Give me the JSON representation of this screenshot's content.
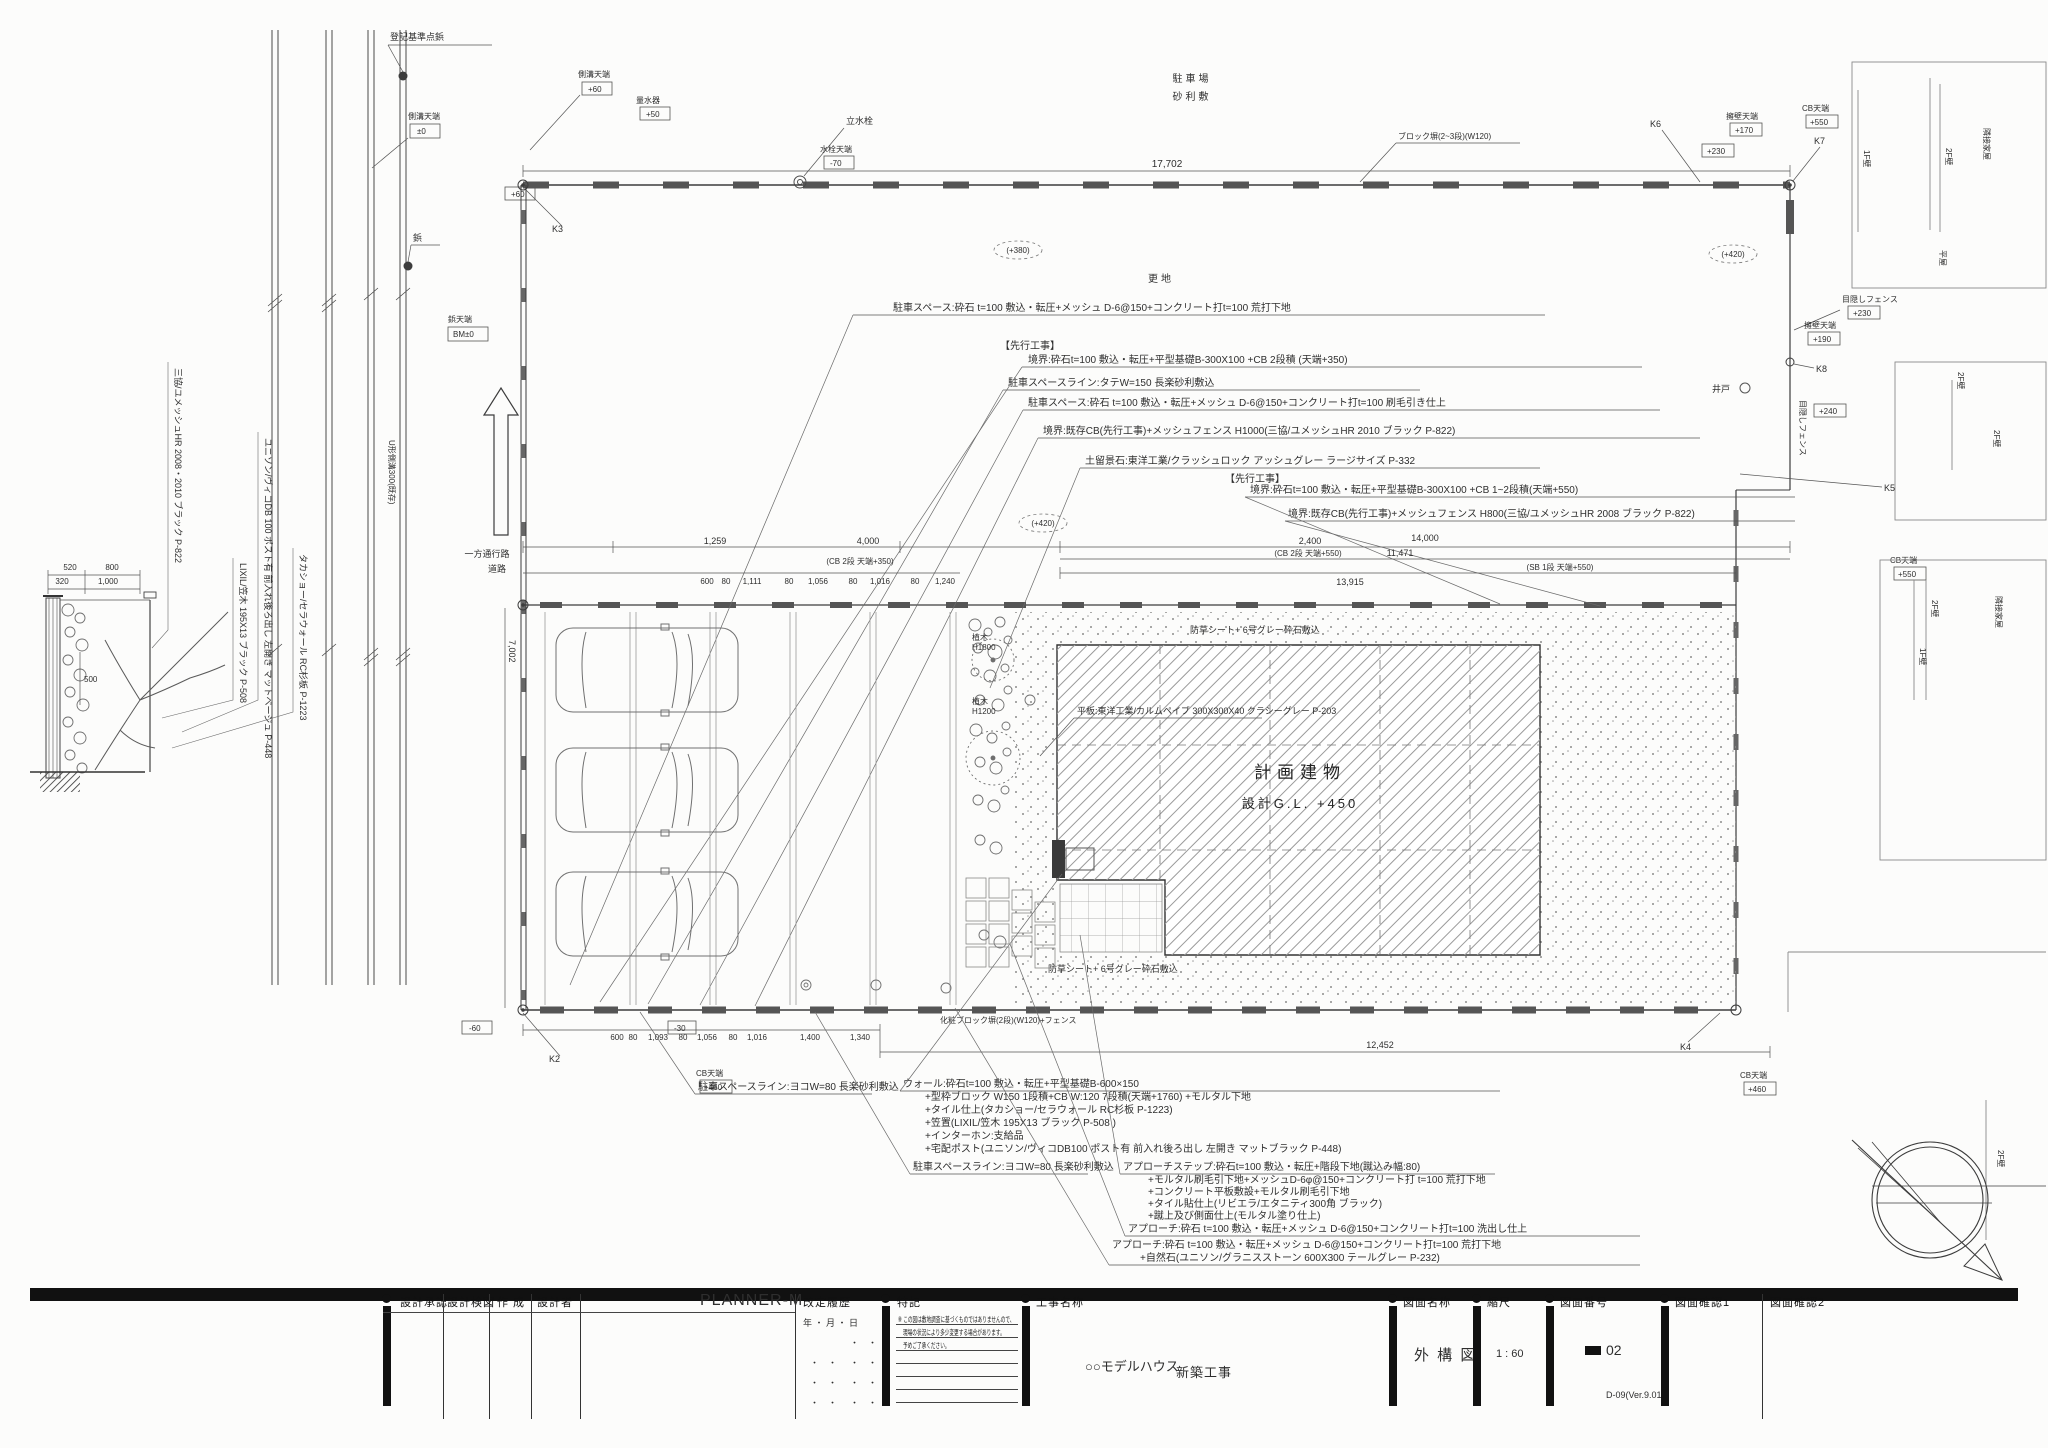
{
  "title_block": {
    "approval": "設計承認",
    "check": "設計検図",
    "create": "作 成",
    "designer_label": "設計者",
    "designer": "PLANNER-M",
    "revision": "改定履歴",
    "revision_date": "年 ・ 月 ・ 日",
    "dot": "・　・",
    "notes_label": "特記",
    "note1": "※ この図は敷地調査に基づくものではありませんので、",
    "note2": "現場の状況により多少変更する場合があります。",
    "note3": "予めご了承ください。",
    "project_label": "工事名称",
    "project_name": "○○モデルハウス",
    "project_type": "新築工事",
    "drawing_label": "図面名称",
    "drawing_name": "外 構 図",
    "scale_label": "縮尺",
    "scale": "1 : 60",
    "number_label": "図面番号",
    "number": "02",
    "version": "D-09(Ver.9.01)",
    "confirm1": "図面確認1",
    "confirm2": "図面確認2"
  },
  "notes_top": [
    "駐車スペース:砕石 t=100 敷込・転圧+メッシュ D-6@150+コンクリート打t=100 荒打下地",
    "【先行工事】",
    "境界:砕石t=100 敷込・転圧+平型基礎B-300X100 +CB 2段積 (天端+350)",
    "駐車スペースライン:タテW=150 長楽砂利敷込",
    "駐車スペース:砕石 t=100 敷込・転圧+メッシュ D-6@150+コンクリート打t=100 刷毛引き仕上",
    "境界:既存CB(先行工事)+メッシュフェンス H1000(三協/ユメッシュHR 2010 ブラック P-822)",
    "土留景石:東洋工業/クラッシュロック アッシュグレー ラージサイズ P-332",
    "【先行工事】",
    "境界:砕石t=100 敷込・転圧+平型基礎B-300X100 +CB 1~2段積(天端+550)",
    "境界:既存CB(先行工事)+メッシュフェンス H800(三協/ユメッシュHR 2008 ブラック P-822)"
  ],
  "notes_wall": [
    "ウォール:砕石t=100 敷込・転圧+平型基礎B-600×150",
    "+型枠ブロック W150 1段積+CB W:120 7段積(天端+1760) +モルタル下地",
    "+タイル仕上(タカショー/セラウォール RC杉板 P-1223)",
    "+笠置(LIXIL/笠木 195X13 ブラック P-508 )",
    "+インターホン:支給品",
    "+宅配ポスト(ユニソン/ヴィコDB100 ポスト有 前入れ後ろ出し 左開き マットブラック P-448)"
  ],
  "notes_step": [
    "アプローチステップ:砕石t=100 敷込・転圧+階段下地(蹴込み幅:80)",
    "+モルタル刷毛引下地+メッシュD-6φ@150+コンクリート打 t=100 荒打下地",
    "+コンクリート平板敷設+モルタル刷毛引下地",
    "+タイル貼仕上(リビエラ/エタニティ300角 ブラック)",
    "+蹴上及び側面仕上(モルタル塗り仕上)"
  ],
  "notes_approach": [
    "アプローチ:砕石 t=100 敷込・転圧+メッシュ D-6@150+コンクリート打t=100 洗出し仕上",
    "アプローチ:砕石 t=100 敷込・転圧+メッシュ D-6@150+コンクリート打t=100 荒打下地",
    "+自然石(ユニソン/グラニスストーン 600X300 テールグレー P-232)"
  ],
  "notes_misc": {
    "parkline_yoko": "駐車スペースライン:ヨコW=80 長楽砂利敷込",
    "plate": "平板:東洋工業/カルムペイブ 300X300X40 クラシーグレー P-203",
    "bousou": "防草シート+ 6号グレー砕石敷込",
    "block_top": "ブロック塀(2~3段)(W120)",
    "block_bottom": "化粧ブロック塀(2段)(W120)+フェンス"
  },
  "building": {
    "name": "計画建物",
    "gl": "設計G.L. +450"
  },
  "site": {
    "sarachi": "更地",
    "parking": "駐車場",
    "gravel": "砂利敷",
    "tap": "立水栓",
    "tap_top": "水栓天端",
    "meter": "量水器",
    "well": "井戸",
    "oneway": "一方通行路",
    "road": "道路",
    "gutter": "U形側溝300(既存)",
    "tree": "植木",
    "tree1h": "H1800",
    "tree2h": "H1200",
    "fence_hide": "目隠しフェンス",
    "youheki": "擁壁天端",
    "cbtop": "CB天端",
    "sokko": "側溝天端",
    "byo": "鋲",
    "byotop": "鋲天端",
    "kijun": "登記基準点鋲",
    "f1": "1F壁",
    "f2": "2F壁",
    "house": "隣接家屋",
    "hiraya": "平屋"
  },
  "levels": {
    "pm0": "±0",
    "bm": "BM±0",
    "p50": "+50",
    "p60": "+60",
    "p170": "+170",
    "p190": "+190",
    "p230": "+230",
    "p240": "+240",
    "p380": "(+380)",
    "p420": "(+420)",
    "p460": "+460",
    "p550": "+550",
    "m30": "-30",
    "m60": "-60",
    "m70": "-70"
  },
  "markers": {
    "k2": "K2",
    "k3": "K3",
    "k4": "K4",
    "k5": "K5",
    "k6": "K6",
    "k7": "K7",
    "k8": "K8"
  },
  "dims": {
    "top": "17,702",
    "rowA": [
      "1,259",
      "4,000",
      "2,400",
      "14,000",
      "11,471",
      "13,915"
    ],
    "rowA_notes": [
      "(CB 2段 天端+350)",
      "(CB 2段 天端+550)",
      "(SB 1段 天端+550)"
    ],
    "rowB": [
      "600",
      "80",
      "1,111",
      "80",
      "1,056",
      "80",
      "1,016",
      "80",
      "1,240"
    ],
    "bottom": [
      "600",
      "80",
      "1,093",
      "80",
      "1,056",
      "80",
      "1,016",
      "1,400",
      "1,340"
    ],
    "bottom_width": "12,452",
    "left": [
      "520",
      "800",
      "320",
      "1,000",
      "500"
    ],
    "depth": "7,002"
  },
  "products_vertical": [
    "三協/ユメッシュHR 2008・2010 ブラック P-822",
    "LIXIL/笠木 195X13 ブラック P-508",
    "ユニソン/ヴィコDB 100 ポスト有 前入れ後ろ出し 左開き マットベージュ P-448",
    "タカショー/セラウォール RC杉板 P-1223"
  ]
}
